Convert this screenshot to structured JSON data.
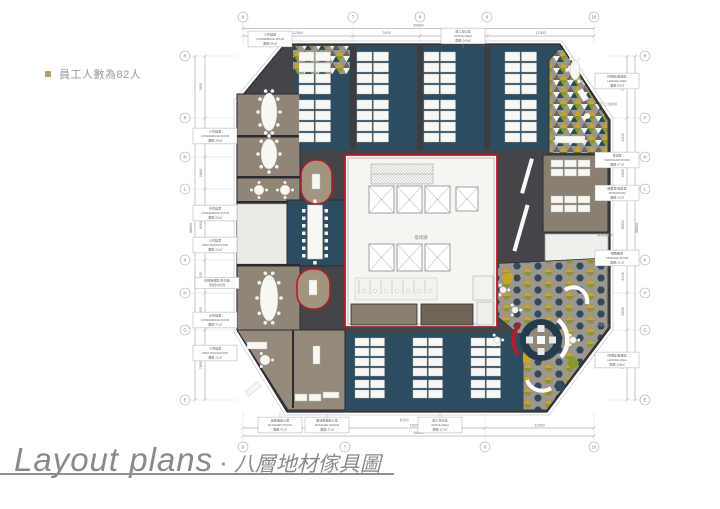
{
  "note": {
    "text": "員工人數為82人"
  },
  "title": {
    "en": "Layout plans",
    "dot": "·",
    "zh": "八層地材傢具圖"
  },
  "colors": {
    "floor_dark": "#454549",
    "carpet_blue": "#2e4c60",
    "room_brown": "#8f8678",
    "core_red": "#ae1f2d",
    "olive": "#8a9630",
    "mustard": "#c7a52b",
    "teal_dark": "#2b4d57",
    "pattern_base": "#9c958b",
    "bullet_tan": "#b59a6a"
  },
  "plan": {
    "core_label": "電梯廳",
    "dims": {
      "top": {
        "bubbles": [
          [
            "6",
            68
          ],
          [
            "7",
            178
          ],
          [
            "8",
            245
          ],
          [
            "9",
            312
          ],
          [
            "10",
            419
          ]
        ],
        "segments": [
          [
            "12300",
            68,
            178
          ],
          [
            "7600",
            178,
            245
          ],
          [
            "7600",
            245,
            312
          ],
          [
            "12300",
            312,
            419
          ]
        ],
        "total": [
          "39800",
          68,
          419
        ]
      },
      "bottom": {
        "bubbles": [
          [
            "6",
            68
          ],
          [
            "7",
            170
          ],
          [
            "9",
            310
          ],
          [
            "10",
            419
          ]
        ],
        "segments": [
          [
            "12200",
            68,
            170
          ],
          [
            "15200",
            170,
            310
          ],
          [
            "12300",
            310,
            419
          ]
        ],
        "total": [
          "39800",
          68,
          419
        ]
      },
      "left": {
        "bubbles": [
          [
            "R",
            48
          ],
          [
            "P",
            110
          ],
          [
            "N",
            149
          ],
          [
            "L",
            181
          ],
          [
            "K",
            252
          ],
          [
            "H",
            285
          ],
          [
            "G",
            322
          ],
          [
            "E",
            392
          ]
        ],
        "segments": [
          [
            "7800",
            48,
            110
          ],
          [
            "4400",
            110,
            149
          ],
          [
            "2600",
            149,
            181
          ],
          [
            "8000",
            181,
            252
          ],
          [
            "4100",
            252,
            285
          ],
          [
            "3900",
            285,
            322
          ],
          [
            "7800",
            322,
            392
          ]
        ],
        "total": [
          "38600",
          48,
          392
        ]
      },
      "right": {
        "bubbles": [
          [
            "R",
            48
          ],
          [
            "P",
            110
          ],
          [
            "N",
            149
          ],
          [
            "L",
            181
          ],
          [
            "K",
            252
          ],
          [
            "H",
            285
          ],
          [
            "G",
            322
          ],
          [
            "E",
            392
          ]
        ],
        "segments": [
          [
            "7800",
            48,
            110
          ],
          [
            "4400",
            110,
            149
          ],
          [
            "2600",
            149,
            181
          ],
          [
            "8000",
            181,
            252
          ],
          [
            "4100",
            252,
            285
          ],
          [
            "3900",
            285,
            322
          ],
          [
            "7800",
            322,
            392
          ]
        ],
        "total": [
          "38600",
          48,
          392
        ]
      }
    },
    "callouts": [
      {
        "side": "left",
        "x": 40,
        "y": 128,
        "lines": [
          "小會議室",
          "CONFERENCE ROOM",
          "面積:19㎡"
        ]
      },
      {
        "side": "left",
        "x": 40,
        "y": 205,
        "lines": [
          "中會議室",
          "CONFERENCE ROOM",
          "面積:28㎡"
        ]
      },
      {
        "side": "left",
        "x": 40,
        "y": 237,
        "lines": [
          "小會議室",
          "DISCUSSION ROOM",
          "面積:12㎡"
        ]
      },
      {
        "side": "left",
        "x": 42,
        "y": 275,
        "lines": [
          "休閒等候區/多功能",
          "彈性使用空間"
        ]
      },
      {
        "side": "left",
        "x": 40,
        "y": 312,
        "lines": [
          "大會議室",
          "CONFERENCE ROOM",
          "面積:41㎡"
        ]
      },
      {
        "side": "left",
        "x": 40,
        "y": 345,
        "lines": [
          "小會議室",
          "DISCUSSION ROOM",
          "面積:12㎡"
        ]
      },
      {
        "side": "top",
        "x": 95,
        "y": 31,
        "lines": [
          "小會議室",
          "CONFERENCE ROOM",
          "面積:36㎡"
        ]
      },
      {
        "side": "top",
        "x": 288,
        "y": 28,
        "lines": [
          "員工辦公區",
          "OFFICE AREA",
          "面積:240㎡"
        ]
      },
      {
        "side": "right",
        "x": 442,
        "y": 73,
        "lines": [
          "休閒區/聯誼區",
          "LEISURE AREA",
          "面積:85㎡"
        ]
      },
      {
        "side": "right",
        "x": 442,
        "y": 152,
        "lines": [
          "會議室",
          "WORKSHOP ROOM",
          "面積:27㎡"
        ]
      },
      {
        "side": "right",
        "x": 442,
        "y": 185,
        "lines": [
          "儲藏室/檔案室",
          "WORKROOM",
          "面積:15㎡"
        ]
      },
      {
        "side": "right",
        "x": 442,
        "y": 250,
        "lines": [
          "網路機房",
          "STORAGE ROOM",
          "面積:11㎡"
        ]
      },
      {
        "side": "right",
        "x": 442,
        "y": 352,
        "lines": [
          "休閒區/聯誼區",
          "LEISURE AREA",
          "面積:108㎡"
        ]
      },
      {
        "side": "bottom",
        "x": 105,
        "y": 417,
        "lines": [
          "總經理辦公室",
          "MANAGER OFFICE",
          "面積:41㎡"
        ]
      },
      {
        "side": "bottom",
        "x": 152,
        "y": 417,
        "lines": [
          "副總經理辦公室",
          "MANAGER OFFICE",
          "面積:37㎡"
        ]
      },
      {
        "side": "bottom",
        "x": 265,
        "y": 417,
        "lines": [
          "員工休息區",
          "OFFICE AREA",
          "面積:117㎡"
        ]
      }
    ],
    "notes": [
      {
        "x": 162,
        "y": 41,
        "t": "飲水台"
      },
      {
        "x": 433,
        "y": 97,
        "t": "員工上班動線"
      },
      {
        "x": 430,
        "y": 228,
        "t": "茶水間區域"
      },
      {
        "x": 428,
        "y": 318,
        "t": "休閒吧台"
      },
      {
        "x": 229,
        "y": 413,
        "t": "茶水間"
      }
    ],
    "desk_clusters": [
      {
        "x": 124,
        "y": 44
      },
      {
        "x": 124,
        "y": 92
      },
      {
        "x": 182,
        "y": 44
      },
      {
        "x": 182,
        "y": 92
      },
      {
        "x": 249,
        "y": 44
      },
      {
        "x": 249,
        "y": 92
      },
      {
        "x": 330,
        "y": 44
      },
      {
        "x": 330,
        "y": 92
      },
      {
        "x": 180,
        "y": 330,
        "dw": 14,
        "dh": 8
      },
      {
        "x": 238,
        "y": 330,
        "dw": 14,
        "dh": 8
      },
      {
        "x": 296,
        "y": 330,
        "dw": 14,
        "dh": 8
      },
      {
        "x": 180,
        "y": 372,
        "rows": 2,
        "dw": 14,
        "dh": 8
      },
      {
        "x": 238,
        "y": 372,
        "rows": 2,
        "dw": 14,
        "dh": 8
      },
      {
        "x": 296,
        "y": 372,
        "rows": 2,
        "dw": 14,
        "dh": 8
      },
      {
        "x": 376,
        "y": 152,
        "cols": 3,
        "rows": 2,
        "dw": 12,
        "dh": 7
      },
      {
        "x": 376,
        "y": 188,
        "cols": 3,
        "rows": 2,
        "dw": 12,
        "dh": 7
      }
    ],
    "tables": [
      {
        "type": "oval",
        "cx": 94,
        "cy": 104,
        "rx": 8,
        "ry": 19,
        "chairs": 10
      },
      {
        "type": "oval",
        "cx": 94,
        "cy": 146,
        "rx": 8,
        "ry": 15,
        "chairs": 8
      },
      {
        "type": "round",
        "cx": 84,
        "cy": 182,
        "r": 5,
        "chairs": 4
      },
      {
        "type": "round",
        "cx": 110,
        "cy": 182,
        "r": 5,
        "chairs": 4
      },
      {
        "type": "board",
        "cx": 140,
        "cy": 224,
        "w": 15,
        "h": 54
      },
      {
        "type": "oval",
        "cx": 94,
        "cy": 290,
        "rx": 9,
        "ry": 23,
        "chairs": 10
      },
      {
        "type": "round",
        "cx": 90,
        "cy": 352,
        "r": 5,
        "chairs": 3
      },
      {
        "type": "oval",
        "cx": 400,
        "cy": 62,
        "rx": 5,
        "ry": 10,
        "chairs": 6
      },
      {
        "type": "round",
        "cx": 328,
        "cy": 282,
        "r": 3.2,
        "chairs": 3
      },
      {
        "type": "round",
        "cx": 340,
        "cy": 302,
        "r": 3.2,
        "chairs": 3
      },
      {
        "type": "round",
        "cx": 322,
        "cy": 332,
        "r": 3.2,
        "chairs": 3
      },
      {
        "type": "round",
        "cx": 398,
        "cy": 332,
        "r": 3.2,
        "chairs": 3
      }
    ]
  }
}
